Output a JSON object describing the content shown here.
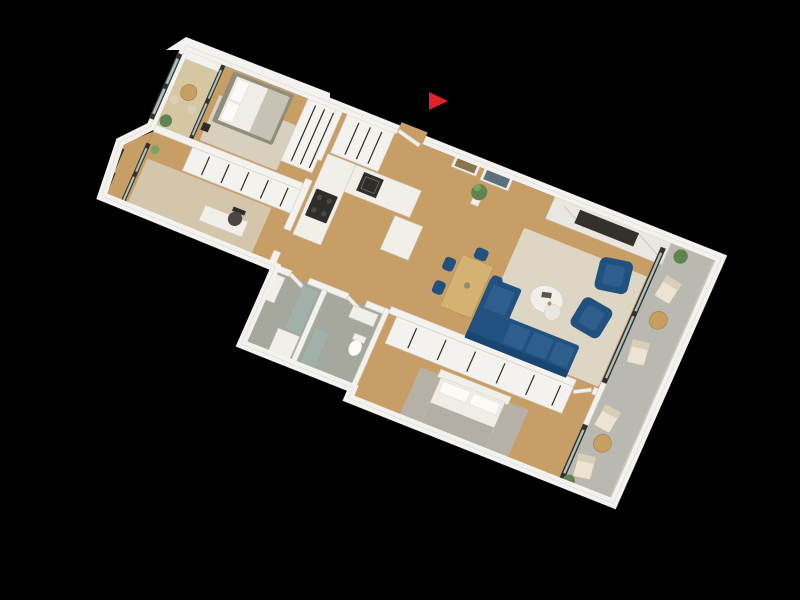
{
  "canvas": {
    "width": 800,
    "height": 600,
    "background": "#000000"
  },
  "scene_type": "3d-apartment-floor-plan-render",
  "marker": {
    "shape": "triangle-right",
    "color": "#e02128"
  },
  "colors": {
    "bg": "#000000",
    "wall": "#f4f2ee",
    "wall_edge": "#d2cec7",
    "wood": "#c89e67",
    "balcony1_floor": "#d6c7a3",
    "rug_living": "#ded6c4",
    "rug_bedroom1": "#d8d0bf",
    "rug_office": "#d3c6ab",
    "rug_gray": "#b6b0a7",
    "tile": "#a6a79d",
    "concrete": "#bab9b1",
    "blue": "#21517e",
    "blue_light": "#2d5e8e",
    "navy_dark": "#1a4570",
    "table_wood": "#d4b271",
    "table_balcony": "#c79f60",
    "cream": "#ebe4d4",
    "cream_dark": "#d9cfb9",
    "plant": "#5f8450",
    "plant_light": "#79a263",
    "dark_frame": "#34322f",
    "fixture_dark": "#2f2d2a",
    "glass": "#a9c0bd",
    "glass_shower": "#9db8b1",
    "white_soft": "#f2efe8",
    "duvet": "#efede5",
    "pillow": "#fbfaf6",
    "throw": "#c7c2b6",
    "throw_gray": "#b3aea6",
    "olive": "#8e8e79",
    "marble": "#eae7e1",
    "tv": "#34312d",
    "chair_office": "#4b4642",
    "handle": "#332f2b",
    "art_gold": "#8a7450",
    "art_blue": "#5d6f7d",
    "marker": "#e02128"
  }
}
